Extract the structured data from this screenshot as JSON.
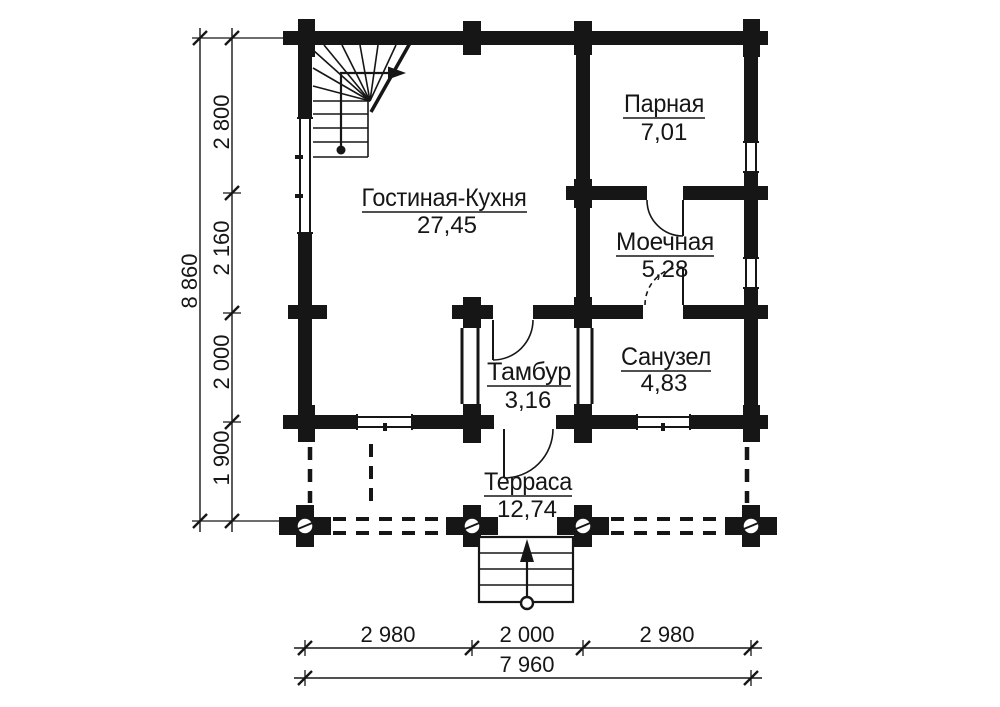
{
  "plan": {
    "rooms": {
      "living": {
        "name": "Гостиная-Кухня",
        "area": "27,45"
      },
      "sauna": {
        "name": "Парная",
        "area": "7,01"
      },
      "washing": {
        "name": "Моечная",
        "area": "5,28"
      },
      "vestibule": {
        "name": "Тамбур",
        "area": "3,16"
      },
      "bathroom": {
        "name": "Санузел",
        "area": "4,83"
      },
      "terrace": {
        "name": "Терраса",
        "area": "12,74"
      }
    },
    "dimensions": {
      "left": {
        "total": "8 860",
        "segments": [
          "2 800",
          "2 160",
          "2 000",
          "1 900"
        ]
      },
      "bottom": {
        "total": "7 960",
        "segments": [
          "2 980",
          "2 000",
          "2 980"
        ]
      }
    },
    "colors": {
      "ink": "#161616",
      "paper": "#ffffff"
    }
  }
}
